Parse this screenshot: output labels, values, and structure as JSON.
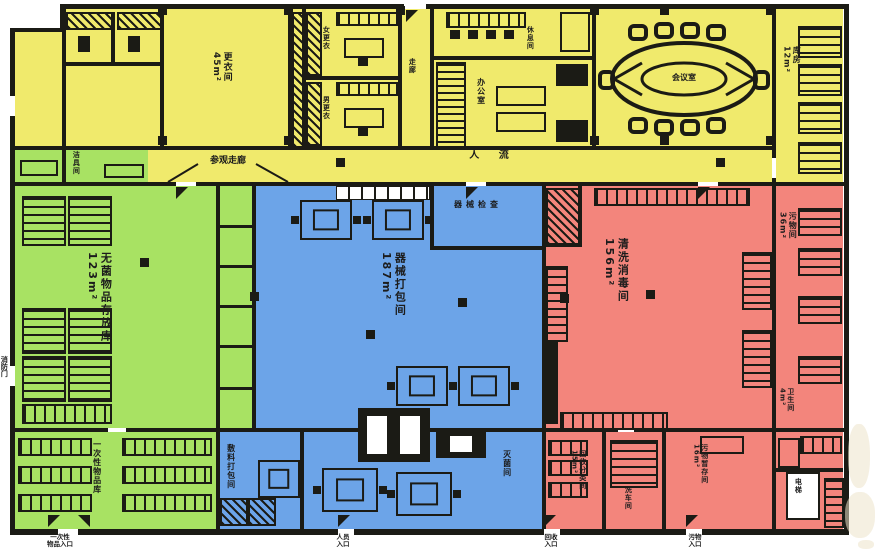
{
  "title": "消毒供应中心平面图",
  "colors": {
    "office_zone_yellow": "#f0ea6c",
    "sterile_zone_green": "#a8e263",
    "clean_zone_blue": "#6ca4e8",
    "dirty_zone_red": "#f3857c",
    "wall_black": "#1b1b15",
    "background": "#ffffff"
  },
  "rooms": {
    "sterile_store": "无菌物品存放库\n123m²",
    "instrument_pack": "器械打包间\n187m²",
    "wash_disinfect": "清洗消毒间\n156m²",
    "changing": "更衣间\n45m²",
    "locker_room_f": "女更衣",
    "locker_room_m": "男更衣",
    "passage": "走廊",
    "rest_room": "休息间",
    "office": "办公室",
    "meeting_room": "会议室",
    "store_right": "库房\n12m²",
    "cleaning_tools": "洁具间",
    "waste_corridor": "污物间\n36m²",
    "washroom_small": "卫生间\n4m²",
    "disposable_store": "一次性物品库",
    "dressing_pack": "敷料打包间",
    "sterilizer_room": "灭菌间",
    "inspection": "器械检查",
    "recycle_sort": "回收分类间\n15m²",
    "cart_wash": "洗车间",
    "waste_hold": "污物暂存间\n16m²",
    "elevator": "电梯"
  },
  "corridor": {
    "label": "参观走廊",
    "flow": "人  流"
  },
  "entrances": {
    "disposable": "一次性\n物品入口",
    "staff": "人员\n入口",
    "recycle": "回收\n入口",
    "waste": "污物\n入口",
    "fire_door": "消防门"
  }
}
